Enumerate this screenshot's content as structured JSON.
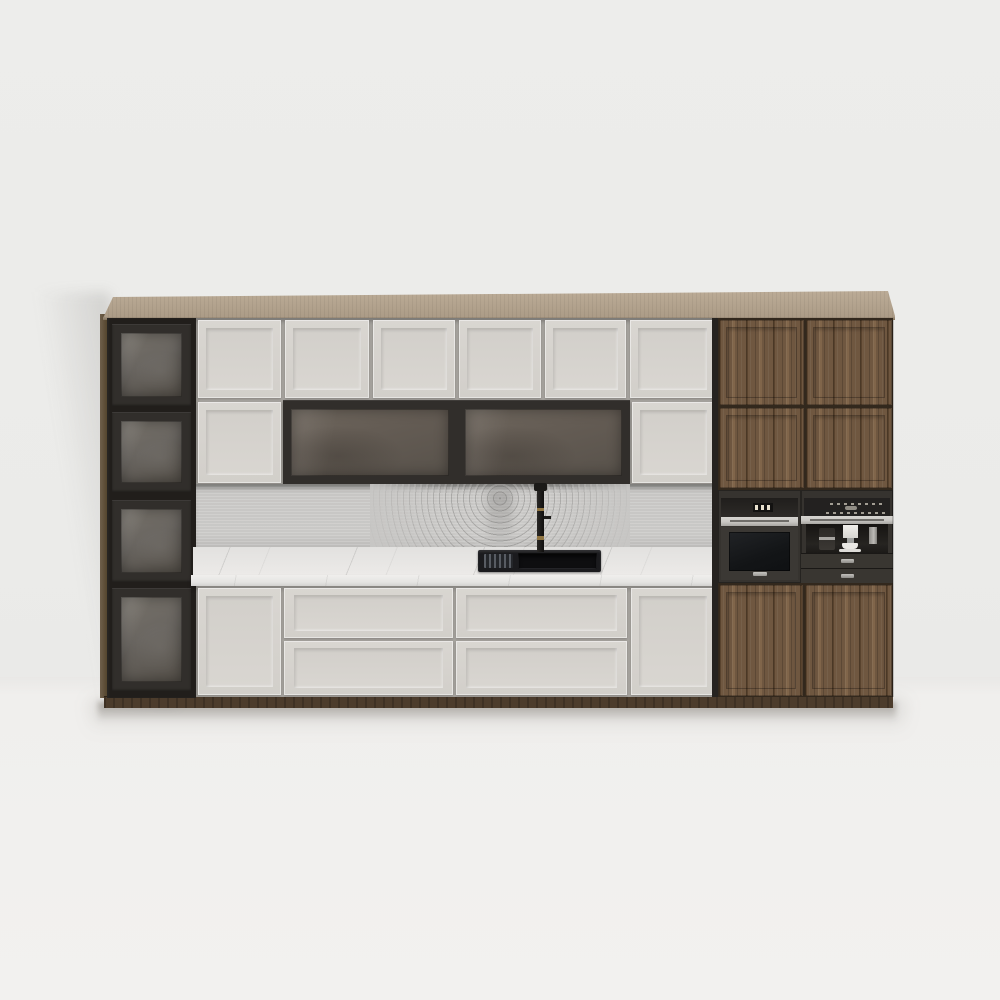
{
  "scene": {
    "description": "3D product render of a modern kitchen wall unit on a light grey wall",
    "style": "front elevation, soft studio lighting, shadow cast on left wall and floor"
  },
  "colors": {
    "wall": "#ebebe9",
    "floor": "#f1f0ee",
    "slab1": "#bcac97",
    "slab2": "#aa9a85",
    "slabEdge": "#84755f",
    "sideWood": "#6f5f4b",
    "frame": "#312e2b",
    "frameDeep": "#211e1b",
    "glassA": "#767169",
    "glassB": "#555049",
    "seam": "#a6a39e",
    "whiteFace": "#d9d6d1",
    "whiteFace2": "#d2cfca",
    "splashBase": "#c7c6c4",
    "counter": "#eae9e7",
    "brass": "#8f7441",
    "steel": "#c9c7c3",
    "steelDark": "#6f6d69",
    "applianceBody": "#36332f",
    "wood": "#6f5740",
    "woodDark": "#59432e",
    "woodLight": "#80654a",
    "toeKick": "#4c3c2c"
  },
  "cabinet": {
    "top_panel": {
      "material": "light wood slab"
    },
    "left_column": {
      "glass_doors": 4,
      "frame_finish": "dark charcoal",
      "glass": "smoked"
    },
    "upper_row": {
      "white_panel_doors": 6
    },
    "middle_row": {
      "white_panel_doors": 2,
      "smoked_glass_doors": 2
    },
    "backsplash": {
      "material": "grey stone",
      "pattern": "concentric rings"
    },
    "countertop": {
      "material": "white marble with grey veining"
    },
    "sink": {
      "color": "black",
      "bowls": 2,
      "accessory": "roll-up dish rack"
    },
    "faucet": {
      "finish": "matte black",
      "accents": "brass"
    },
    "base_row": {
      "tall_doors": 2,
      "drawer_stacks": 2,
      "drawers_per_stack": 2
    },
    "right_section": {
      "material": "walnut wood",
      "upper_doors": 4,
      "lower_doors": 2
    },
    "toe_kick": {
      "material": "dark wood"
    }
  },
  "appliances": {
    "oven": {
      "kind": "built-in oven",
      "finish": "graphite",
      "display_segments": 3,
      "handle": "stainless bar",
      "badge": "brand plaque"
    },
    "coffee_machine": {
      "kind": "built-in coffee machine",
      "finish": "graphite",
      "control_rows": 2,
      "accessories": [
        "grinder",
        "water tank",
        "white cup with saucer"
      ],
      "drawers": 2
    }
  }
}
